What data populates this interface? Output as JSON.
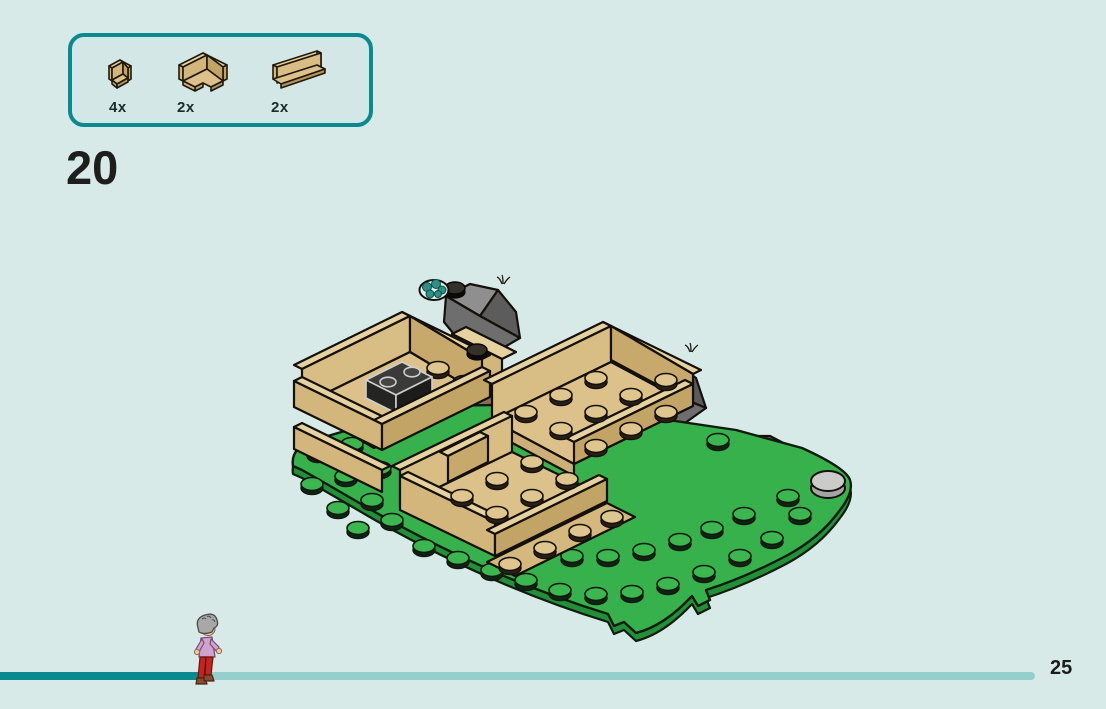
{
  "page": {
    "number": "25",
    "background_color": "#d8eae8"
  },
  "step": {
    "number": "20"
  },
  "parts_panel": {
    "border_color": "#0a8a90",
    "parts": [
      {
        "icon": "corner-panel-1x1-icon",
        "count": "4x"
      },
      {
        "icon": "corner-wall-2x2-icon",
        "count": "2x"
      },
      {
        "icon": "wall-panel-1x4-icon",
        "count": "2x"
      }
    ]
  },
  "model": {
    "description": "Isometric LEGO assembly: rounded green baseplate with studs, three tan walled enclosures, dark gray rock slopes, brown cobble path with studs, gray curved tiles, a dark 1x2 brick and a teal plant tile",
    "colors": {
      "grass_green": "#37b14b",
      "tan_light": "#e6d1a0",
      "tan_mid": "#d2b67c",
      "tan_dark": "#c3a467",
      "path_brown": "#8a7156",
      "rock_gray": "#757575",
      "tile_gray": "#c8c8c8",
      "plant_teal": "#2d8f85"
    }
  },
  "progress": {
    "completed_color": "#088a8e",
    "remaining_color": "#95cfcd",
    "character": "gray-haired minifigure in lavender top and red trousers walking right"
  }
}
